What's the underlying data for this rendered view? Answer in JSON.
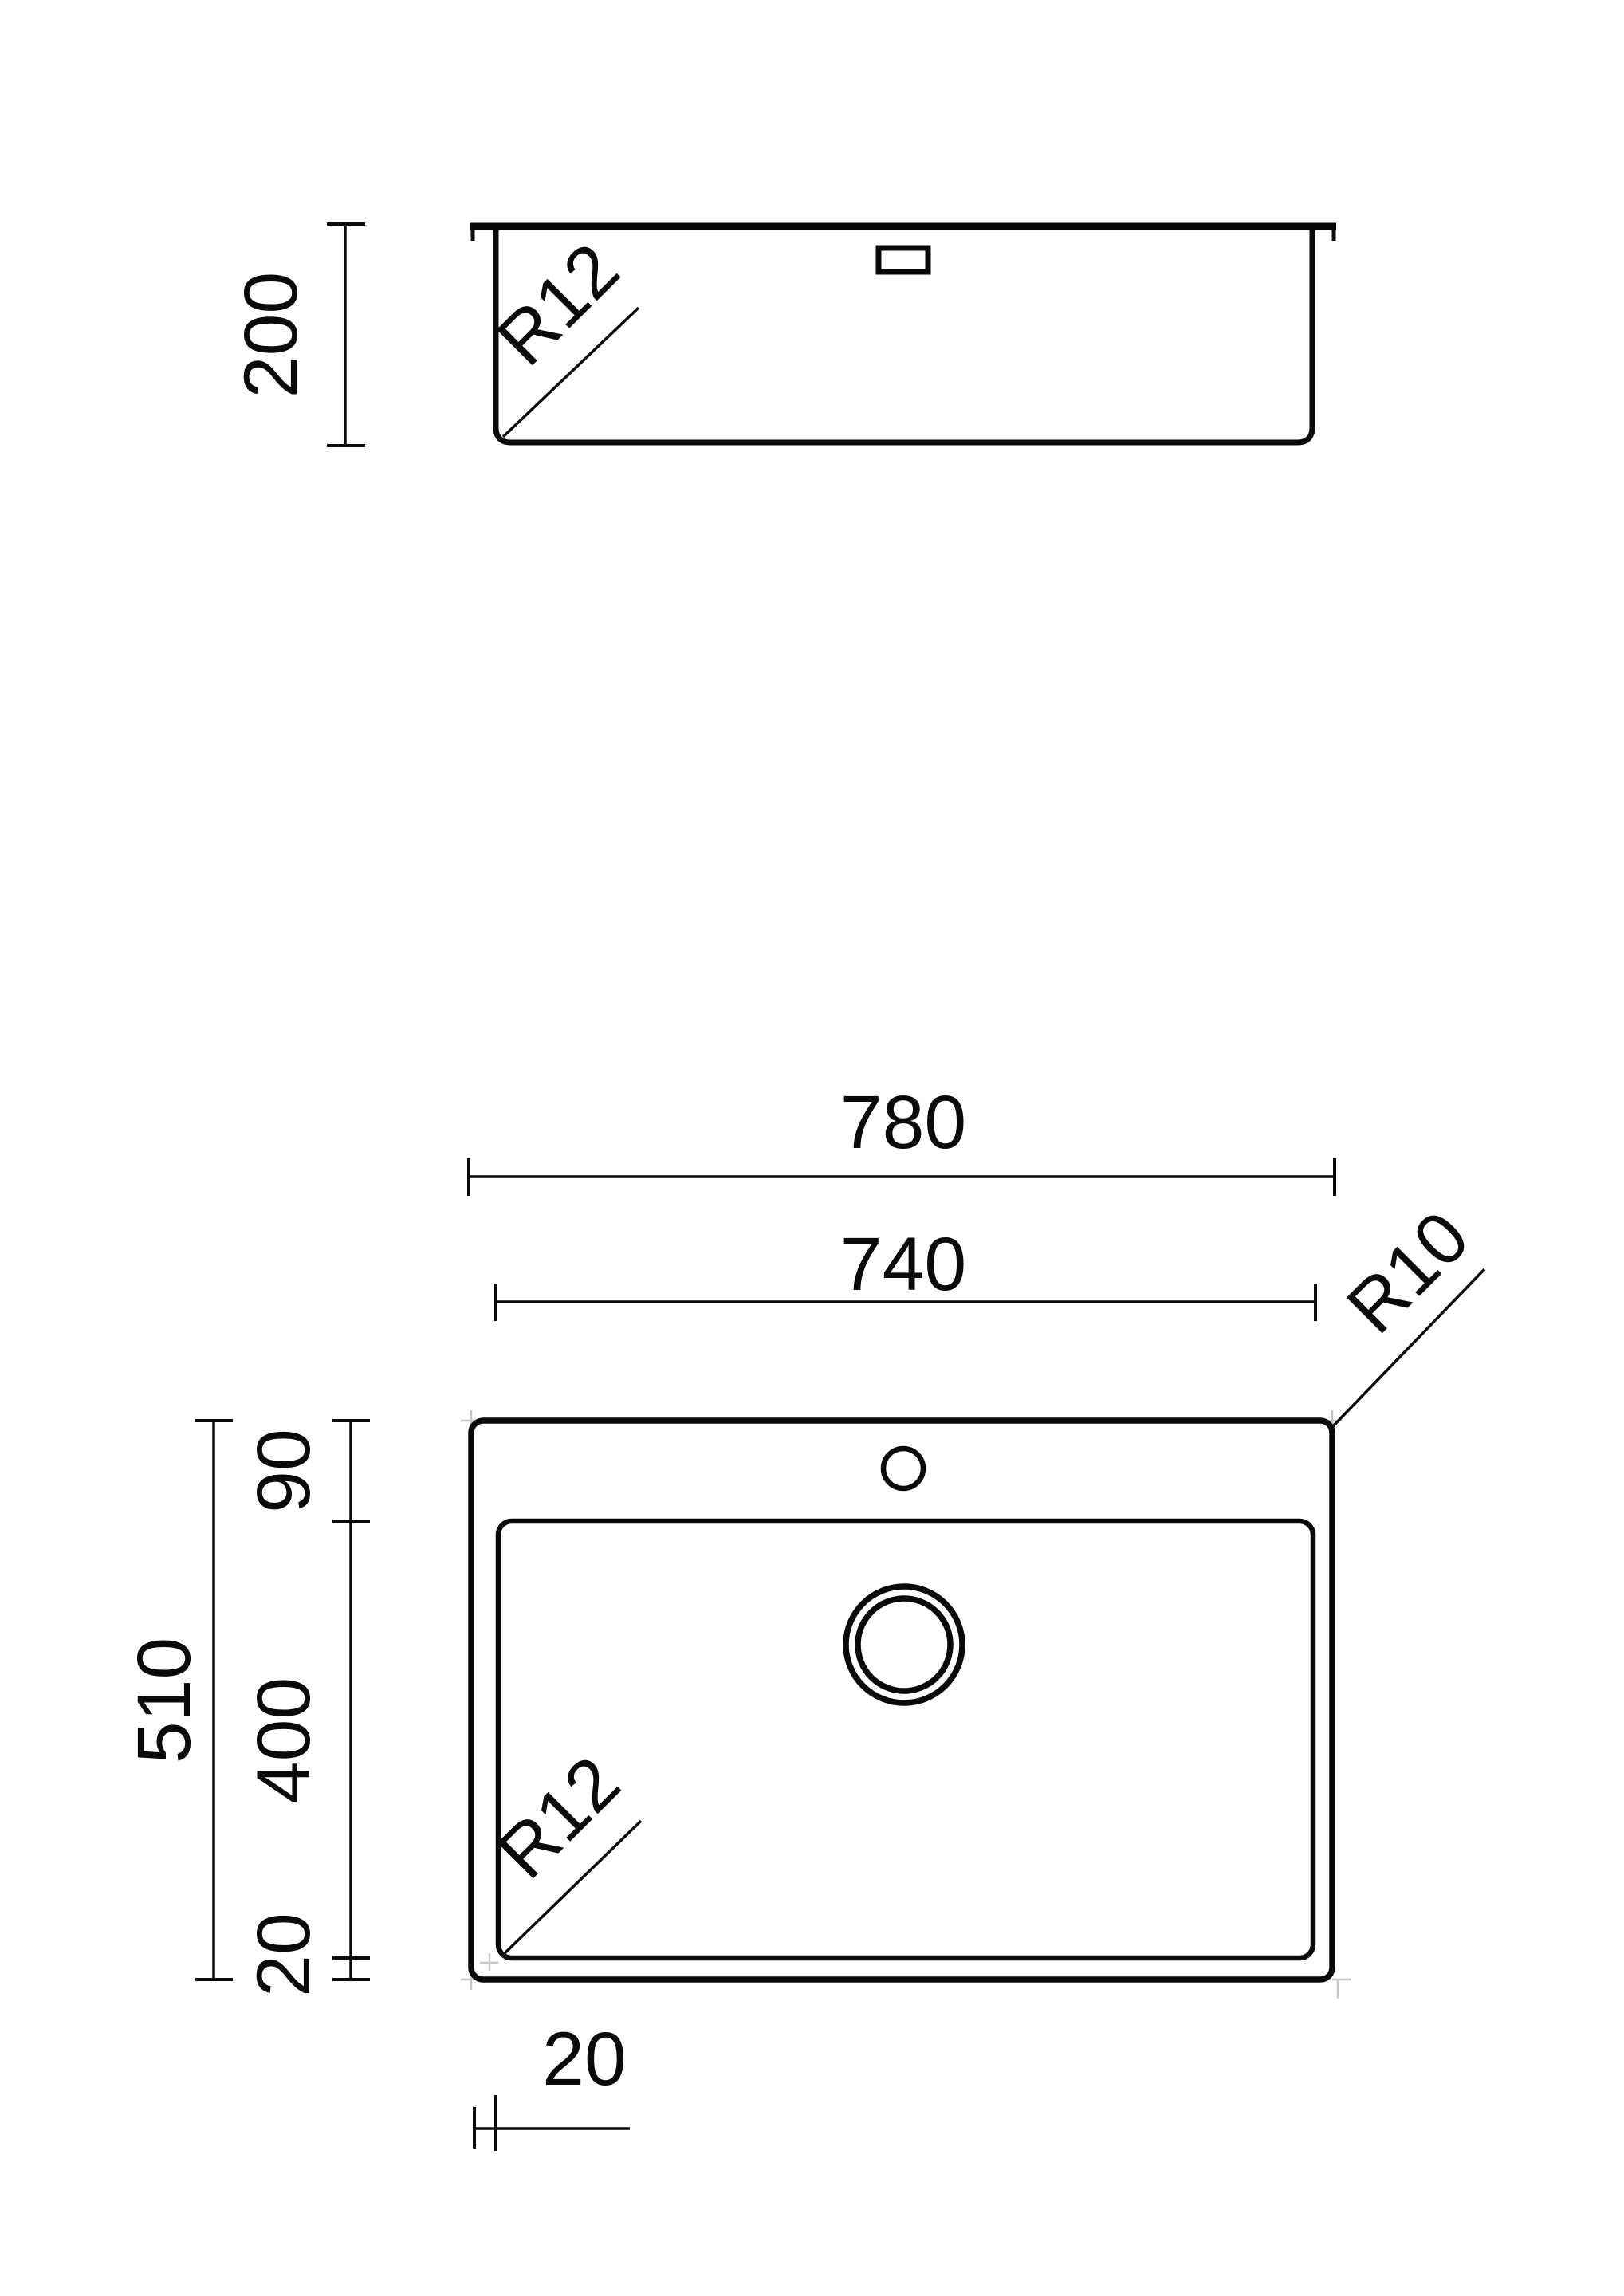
{
  "drawing": {
    "background_color": "#ffffff",
    "line_color": "#0a0a0a",
    "corner_mark_color": "#c6c6c6",
    "side_view": {
      "title": "side-section-view",
      "depth_label": "200",
      "bowl_corner_radius_label": "R12"
    },
    "plan_view": {
      "title": "top-plan-view",
      "overall_width_label": "780",
      "bowl_width_label": "740",
      "overall_depth_label": "510",
      "ledge_depth_label": "90",
      "bowl_depth_label": "400",
      "bottom_inset_label": "20",
      "side_inset_label": "20",
      "outer_corner_radius_label": "R10",
      "bowl_corner_radius_label": "R12"
    }
  }
}
